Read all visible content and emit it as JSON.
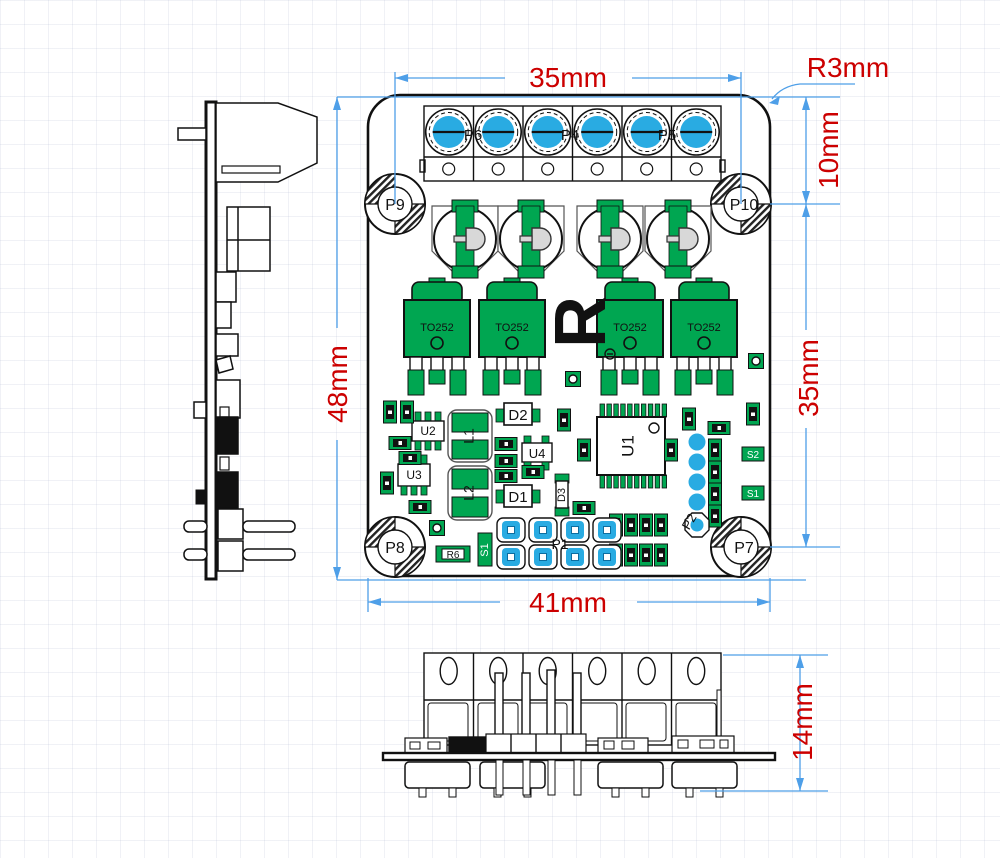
{
  "dimensions": {
    "top_width": "35mm",
    "corner_radius": "R3mm",
    "right_offset": "10mm",
    "right_span": "35mm",
    "left_height": "48mm",
    "bottom_width": "41mm",
    "side_height": "14mm"
  },
  "top_view": {
    "hole_tl": "P9",
    "hole_tr": "P10",
    "hole_bl": "P8",
    "hole_br": "P7",
    "terminal_1": "P6",
    "terminal_2": "P4",
    "terminal_3": "P5",
    "transistor": "TO252",
    "u1": "U1",
    "u2": "U2",
    "u3": "U3",
    "u4": "U4",
    "l1": "L1",
    "l2": "L2",
    "d1": "D1",
    "d2": "D2",
    "d3": "D3",
    "r6": "R6",
    "s1_left": "S1",
    "s2_right": "S2",
    "s1_right": "S1",
    "p1": "P1",
    "p2": "P2",
    "logo": "R"
  },
  "colors": {
    "pad_blue": "#29ABE2",
    "copper_green": "#00A651",
    "dimension_blue": "#4E9FE8",
    "dimension_red": "#CC0000",
    "outline_black": "#111111"
  }
}
